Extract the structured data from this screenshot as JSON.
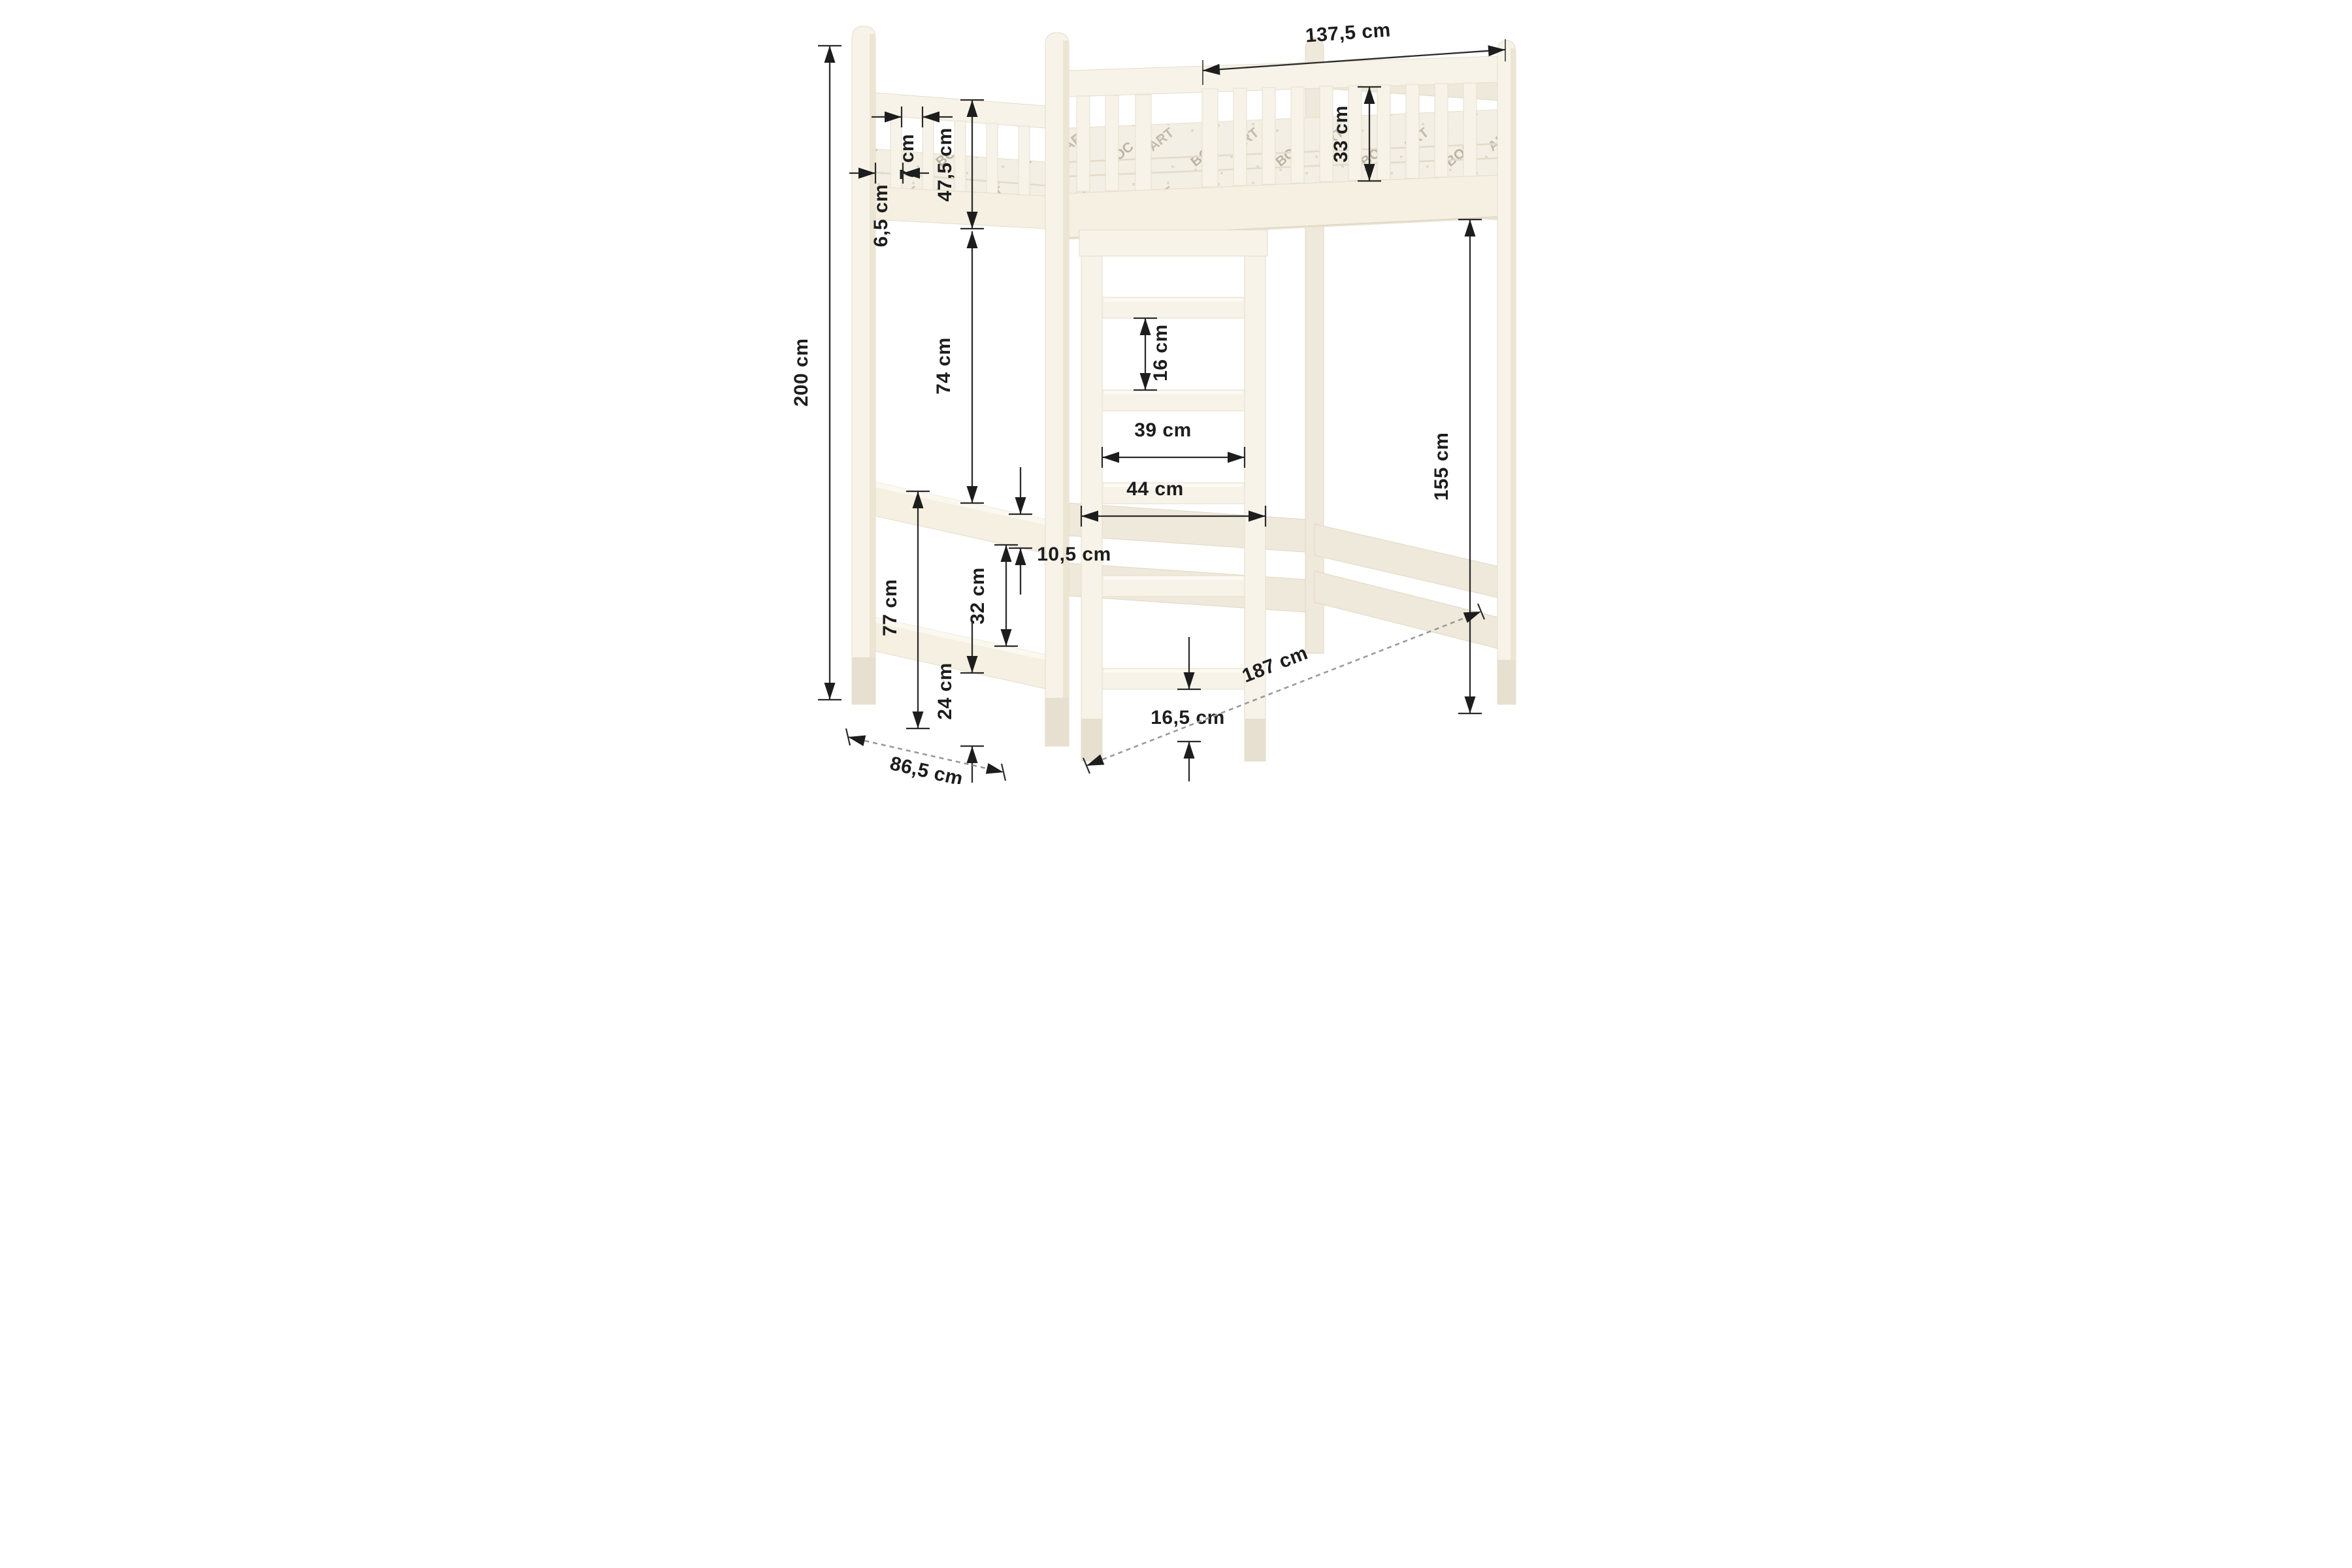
{
  "drawing": {
    "title": "loft-bed-dimension-diagram",
    "background": "#ffffff",
    "wood_color": "#f7f3e9",
    "wood_shadow": "#ece5d4",
    "line_color": "#1d1d1d",
    "labels": {
      "total_height": "200 cm",
      "guard_panel_length": "137,5 cm",
      "headboard_slat_gap": "7 cm",
      "guard_height_total": "47,5 cm",
      "mattress_lip": "6,5 cm",
      "guard_rail_height": "33 cm",
      "frame_to_rail_clearance": "74 cm",
      "ladder_rung_gap": "16 cm",
      "ladder_inner_width": "39 cm",
      "ladder_outer_width": "44 cm",
      "side_rail_height": "10,5 cm",
      "side_rail_gap": "32 cm",
      "rail_top_to_floor": "77 cm",
      "bottom_rail_to_floor": "24 cm",
      "ladder_to_floor": "16,5 cm",
      "under_bed_height": "155 cm",
      "bed_depth": "86,5 cm",
      "bed_length": "187 cm"
    },
    "mattress_print": {
      "t1": "BOC",
      "t2": "ART"
    }
  }
}
